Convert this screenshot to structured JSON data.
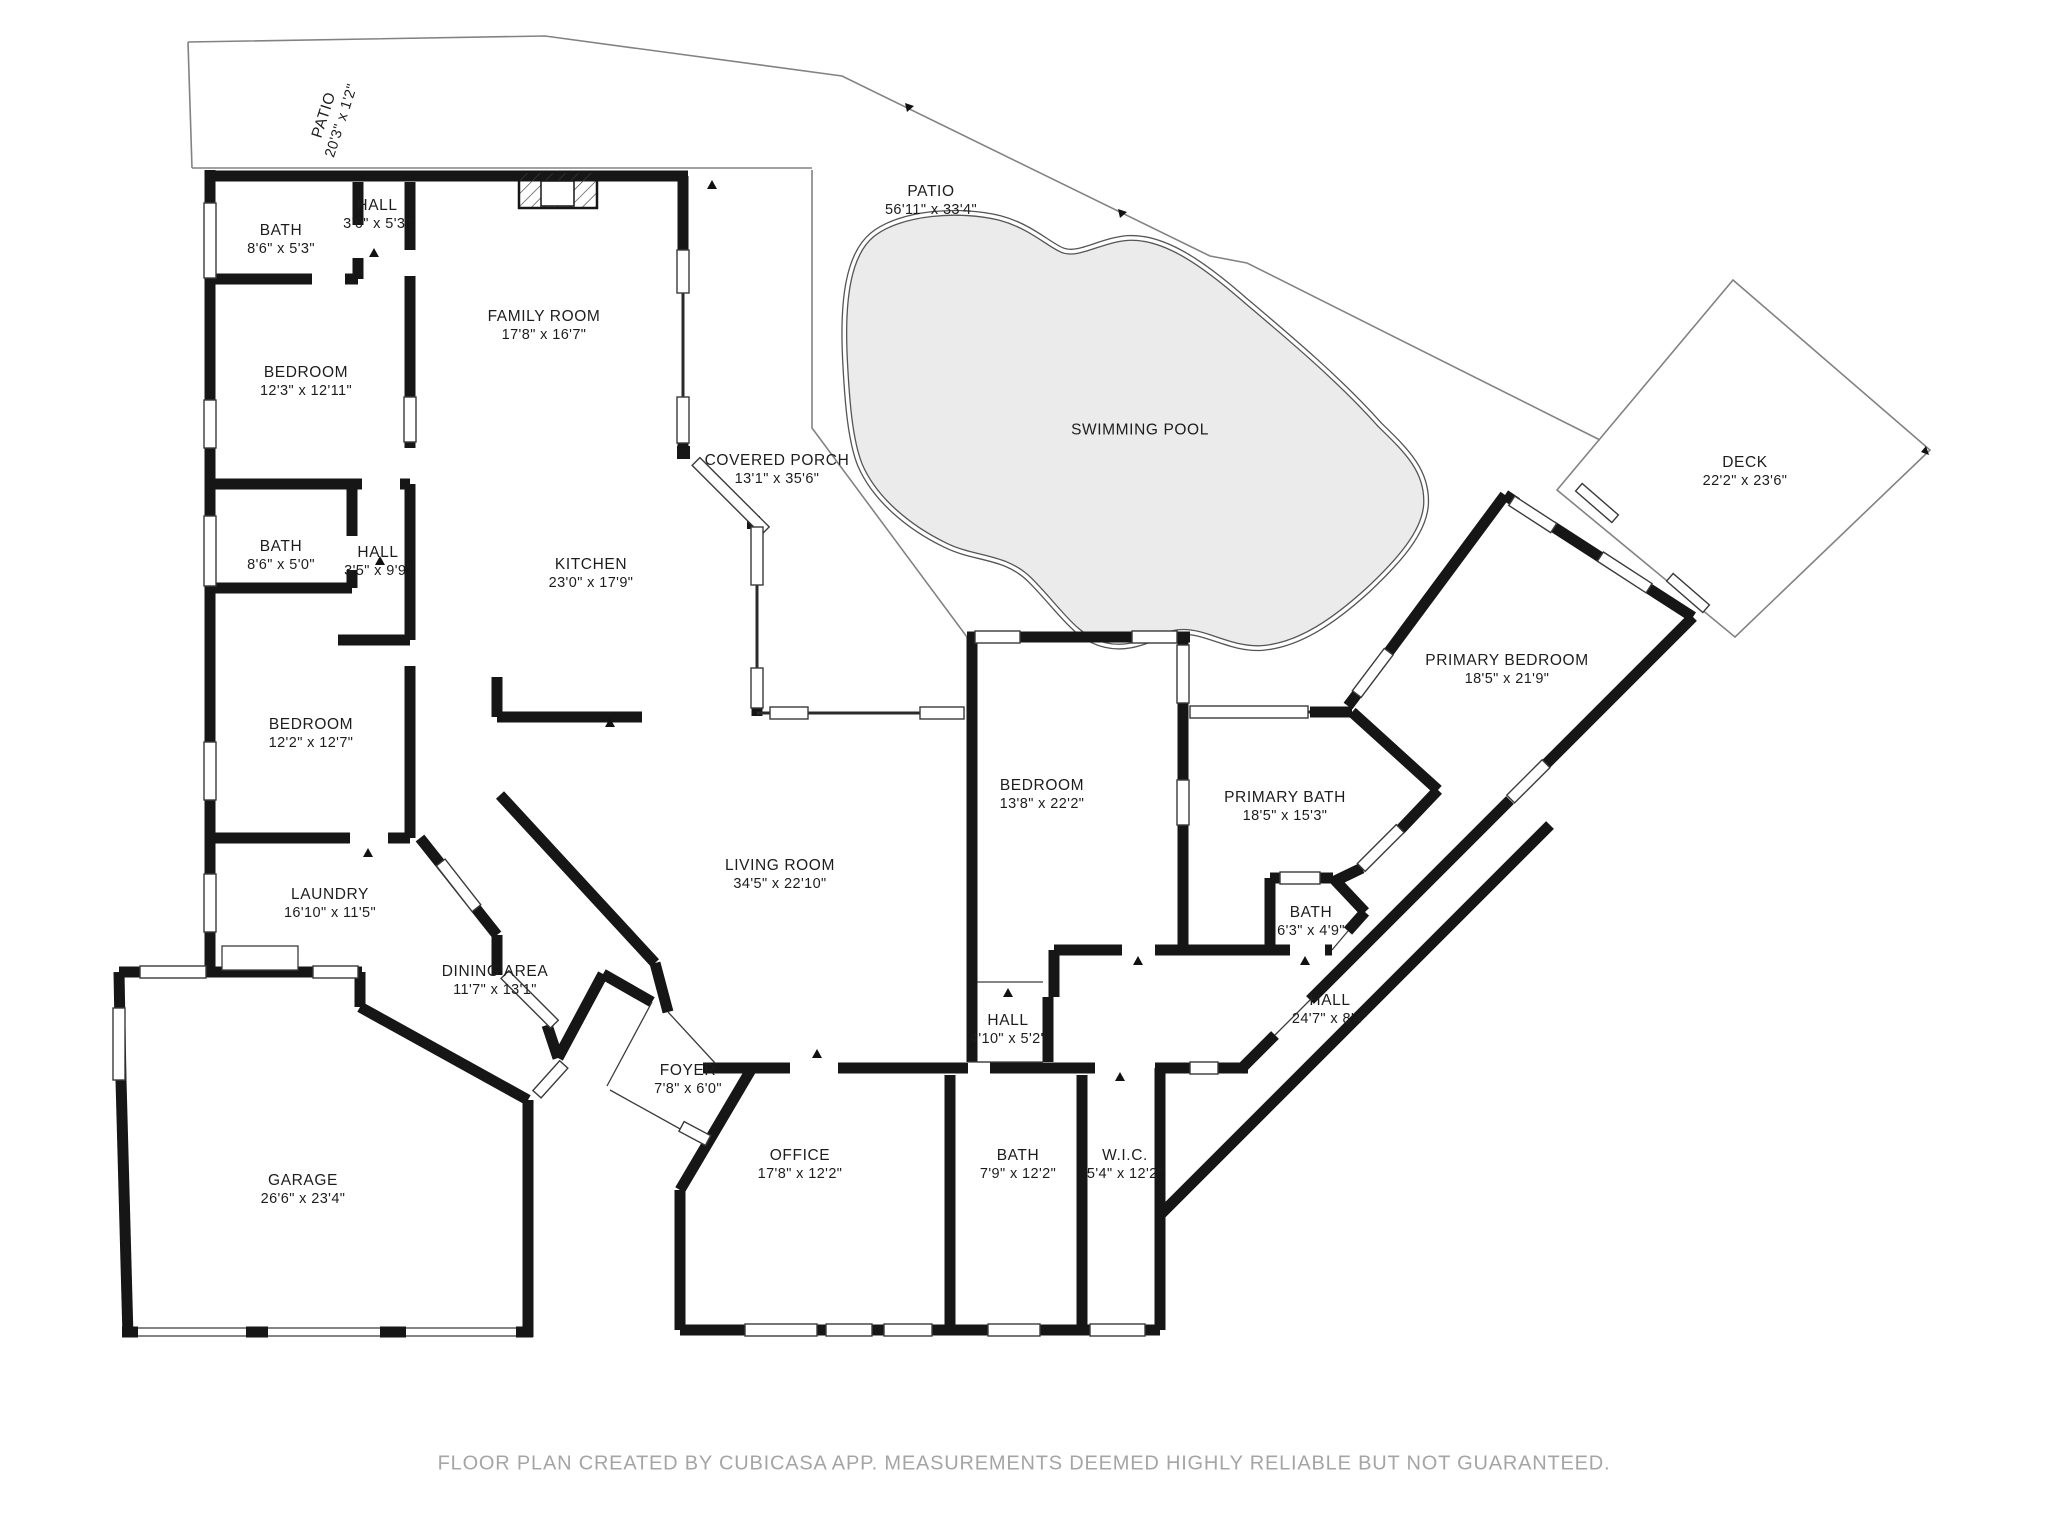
{
  "footer": {
    "text": "FLOOR PLAN CREATED BY CUBICASA APP. MEASUREMENTS DEEMED HIGHLY RELIABLE BUT NOT GUARANTEED."
  },
  "colors": {
    "wall": "#161616",
    "pool_fill": "#ebebeb",
    "boundary": "#828282",
    "footer_text": "#a5a5a5"
  },
  "rooms": [
    {
      "name": "PATIO",
      "dims": "20'3\" x 1'2\""
    },
    {
      "name": "BATH",
      "dims": "8'6\" x 5'3\""
    },
    {
      "name": "HALL",
      "dims": "3'6\" x 5'3\""
    },
    {
      "name": "BEDROOM",
      "dims": "12'3\" x 12'11\""
    },
    {
      "name": "FAMILY ROOM",
      "dims": "17'8\" x 16'7\""
    },
    {
      "name": "KITCHEN",
      "dims": "23'0\" x 17'9\""
    },
    {
      "name": "COVERED PORCH",
      "dims": "13'1\" x 35'6\""
    },
    {
      "name": "PATIO",
      "dims": "56'11\" x 33'4\""
    },
    {
      "name": "SWIMMING POOL",
      "dims": ""
    },
    {
      "name": "DECK",
      "dims": "22'2\" x 23'6\""
    },
    {
      "name": "BATH",
      "dims": "8'6\" x 5'0\""
    },
    {
      "name": "HALL",
      "dims": "3'5\" x 9'9\""
    },
    {
      "name": "BEDROOM",
      "dims": "12'2\" x 12'7\""
    },
    {
      "name": "LAUNDRY",
      "dims": "16'10\" x 11'5\""
    },
    {
      "name": "DINING AREA",
      "dims": "11'7\" x 13'1\""
    },
    {
      "name": "LIVING ROOM",
      "dims": "34'5\" x 22'10\""
    },
    {
      "name": "BEDROOM",
      "dims": "13'8\" x 22'2\""
    },
    {
      "name": "PRIMARY BATH",
      "dims": "18'5\" x 15'3\""
    },
    {
      "name": "BATH",
      "dims": "6'3\" x 4'9\""
    },
    {
      "name": "HALL",
      "dims": "24'7\" x 8'4\""
    },
    {
      "name": "PRIMARY BEDROOM",
      "dims": "18'5\" x 21'9\""
    },
    {
      "name": "FOYER",
      "dims": "7'8\" x 6'0\""
    },
    {
      "name": "HALL",
      "dims": "4'10\" x 5'2\""
    },
    {
      "name": "OFFICE",
      "dims": "17'8\" x 12'2\""
    },
    {
      "name": "BATH",
      "dims": "7'9\" x 12'2\""
    },
    {
      "name": "W.I.C.",
      "dims": "5'4\" x 12'2\""
    },
    {
      "name": "GARAGE",
      "dims": "26'6\" x 23'4\""
    }
  ]
}
